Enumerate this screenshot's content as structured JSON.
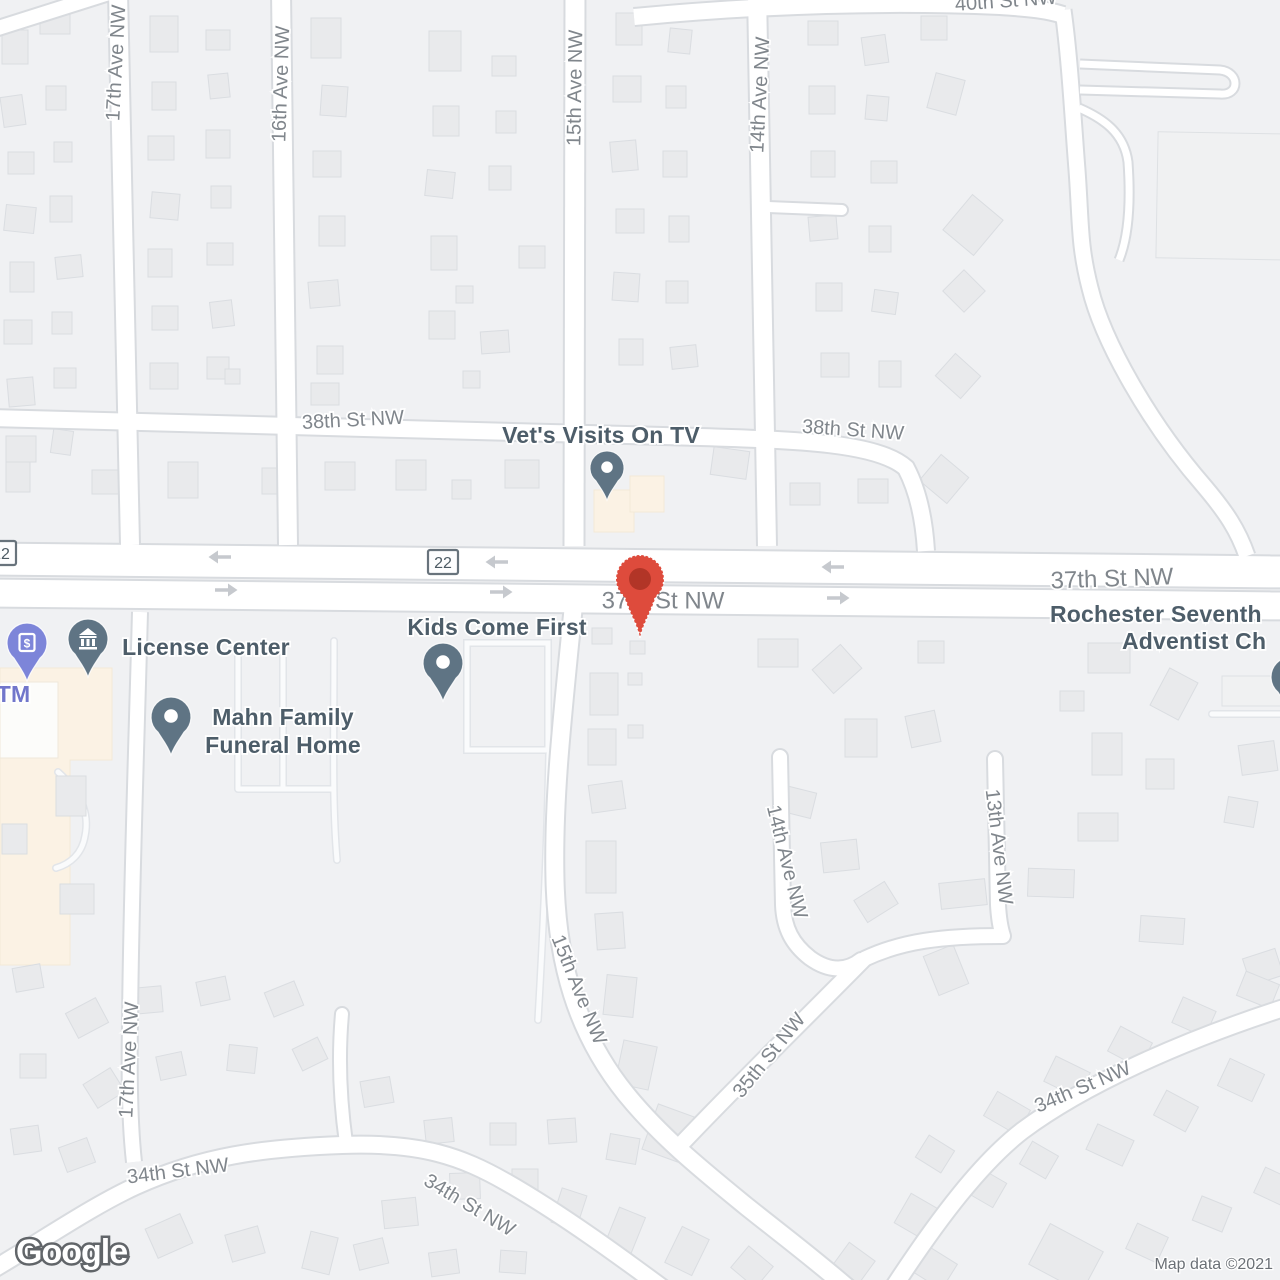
{
  "map": {
    "logo_text": "Google",
    "attribution_text": "Map data ©2021"
  },
  "colors": {
    "background": "#F0F1F3",
    "road_fill": "#FFFFFF",
    "road_casing": "#D8DBDF",
    "lane_casing": "#E2E5E9",
    "lane_fill": "#FAFBFC",
    "building_fill": "#E9EAEC",
    "building_stroke": "#DADDE1",
    "building_light_fill": "#F0F1F2",
    "commercial_fill": "#FBF2E4",
    "commercial_stroke": "#F3E9D7",
    "street_label": "#80868C",
    "poi_label": "#4D5D69",
    "atm_label": "#7176CB",
    "pin_slate": "#5F7484",
    "pin_purple": "#7D85D9",
    "marker_body": "#DE4B3C",
    "marker_dot": "#B23527",
    "arrow": "#C6C9CE",
    "shield_border": "#68737C",
    "shield_text": "#4C5A63",
    "shield_fill": "#FDFDFE",
    "attribution_text": "#6B7076",
    "logo_stroke": "#616569"
  },
  "icons": {
    "atm_glyph": "$"
  },
  "street_labels": [
    {
      "text": "17th Ave NW",
      "x": 117,
      "y": 63,
      "rot": -87,
      "size": 20
    },
    {
      "text": "16th Ave NW",
      "x": 282,
      "y": 84,
      "rot": -88,
      "size": 20
    },
    {
      "text": "15th Ave NW",
      "x": 576,
      "y": 88,
      "rot": -89,
      "size": 20
    },
    {
      "text": "14th Ave NW",
      "x": 761,
      "y": 95,
      "rot": -87,
      "size": 20
    },
    {
      "text": "40th St NW",
      "x": 1006,
      "y": 2,
      "rot": -4,
      "size": 20
    },
    {
      "text": "38th St NW",
      "x": 353,
      "y": 421,
      "rot": -3,
      "size": 20
    },
    {
      "text": "38th St NW",
      "x": 853,
      "y": 431,
      "rot": 4,
      "size": 20
    },
    {
      "text": "37th St NW",
      "x": 663,
      "y": 602,
      "rot": 0,
      "size": 24
    },
    {
      "text": "37th St NW",
      "x": 1112,
      "y": 580,
      "rot": -2,
      "size": 24
    },
    {
      "text": "17th Ave NW",
      "x": 130,
      "y": 1060,
      "rot": -87,
      "size": 20
    },
    {
      "text": "15th Ave NW",
      "x": 578,
      "y": 990,
      "rot": 68,
      "size": 20
    },
    {
      "text": "14th Ave NW",
      "x": 786,
      "y": 862,
      "rot": 76,
      "size": 20
    },
    {
      "text": "13th Ave NW",
      "x": 998,
      "y": 847,
      "rot": 83,
      "size": 20
    },
    {
      "text": "35th St NW",
      "x": 770,
      "y": 1056,
      "rot": -51,
      "size": 20
    },
    {
      "text": "34th St NW",
      "x": 178,
      "y": 1172,
      "rot": -7,
      "size": 20
    },
    {
      "text": "34th St NW",
      "x": 469,
      "y": 1206,
      "rot": 31,
      "size": 20
    },
    {
      "text": "34th St NW",
      "x": 1083,
      "y": 1088,
      "rot": -23,
      "size": 20
    }
  ],
  "shields": [
    {
      "text": "22",
      "x": 1,
      "y": 553
    },
    {
      "text": "22",
      "x": 443,
      "y": 562
    }
  ],
  "arrows": [
    {
      "x": 220,
      "y": 557,
      "dir": "left"
    },
    {
      "x": 497,
      "y": 562,
      "dir": "left"
    },
    {
      "x": 833,
      "y": 567,
      "dir": "left"
    },
    {
      "x": 226,
      "y": 590,
      "dir": "right"
    },
    {
      "x": 501,
      "y": 592,
      "dir": "right"
    },
    {
      "x": 838,
      "y": 598,
      "dir": "right"
    }
  ],
  "pois": [
    {
      "id": "vets-visits-on-tv",
      "name": "Vet's Visits On TV",
      "pin": "dot",
      "pin_color": "#5F7484",
      "pin_x": 607,
      "pin_y": 468,
      "pin_scale": 0.85,
      "lines": [
        {
          "text": "Vet's Visits On TV",
          "x": 601,
          "y": 443,
          "anchor": "middle"
        }
      ]
    },
    {
      "id": "kids-come-first",
      "name": "Kids Come First",
      "pin": "dot",
      "pin_color": "#5F7484",
      "pin_x": 443,
      "pin_y": 663,
      "pin_scale": 1,
      "lines": [
        {
          "text": "Kids Come First",
          "x": 497,
          "y": 635,
          "anchor": "middle"
        }
      ]
    },
    {
      "id": "license-center",
      "name": "License Center",
      "pin": "museum",
      "pin_color": "#5F7484",
      "pin_x": 88,
      "pin_y": 639,
      "pin_scale": 1,
      "lines": [
        {
          "text": "License Center",
          "x": 206,
          "y": 655,
          "anchor": "middle"
        }
      ]
    },
    {
      "id": "atm",
      "name": "ATM",
      "pin": "atm",
      "pin_color": "#7D85D9",
      "label_color": "#7176CB",
      "pin_x": 27,
      "pin_y": 643,
      "pin_scale": 1,
      "lines": [
        {
          "text": "ATM",
          "x": 6,
          "y": 702,
          "anchor": "middle"
        }
      ]
    },
    {
      "id": "mahn-family-funeral-home",
      "name": "Mahn Family Funeral Home",
      "pin": "dot",
      "pin_color": "#5F7484",
      "pin_x": 171,
      "pin_y": 717,
      "pin_scale": 1,
      "lines": [
        {
          "text": "Mahn Family",
          "x": 283,
          "y": 725,
          "anchor": "middle"
        },
        {
          "text": "Funeral Home",
          "x": 283,
          "y": 753,
          "anchor": "middle"
        }
      ]
    },
    {
      "id": "rochester-seventh-day-adventist-church",
      "name": "Rochester Seventh Adventist Ch",
      "pin": "dot",
      "pin_color": "#5F7484",
      "pin_x": 1291,
      "pin_y": 677,
      "pin_scale": 1,
      "lines": [
        {
          "text": "Rochester Seventh",
          "x": 1050,
          "y": 622,
          "anchor": "start"
        },
        {
          "text": "Adventist Ch",
          "x": 1122,
          "y": 649,
          "anchor": "start"
        }
      ]
    }
  ],
  "marker": {
    "x": 640,
    "y": 579
  }
}
